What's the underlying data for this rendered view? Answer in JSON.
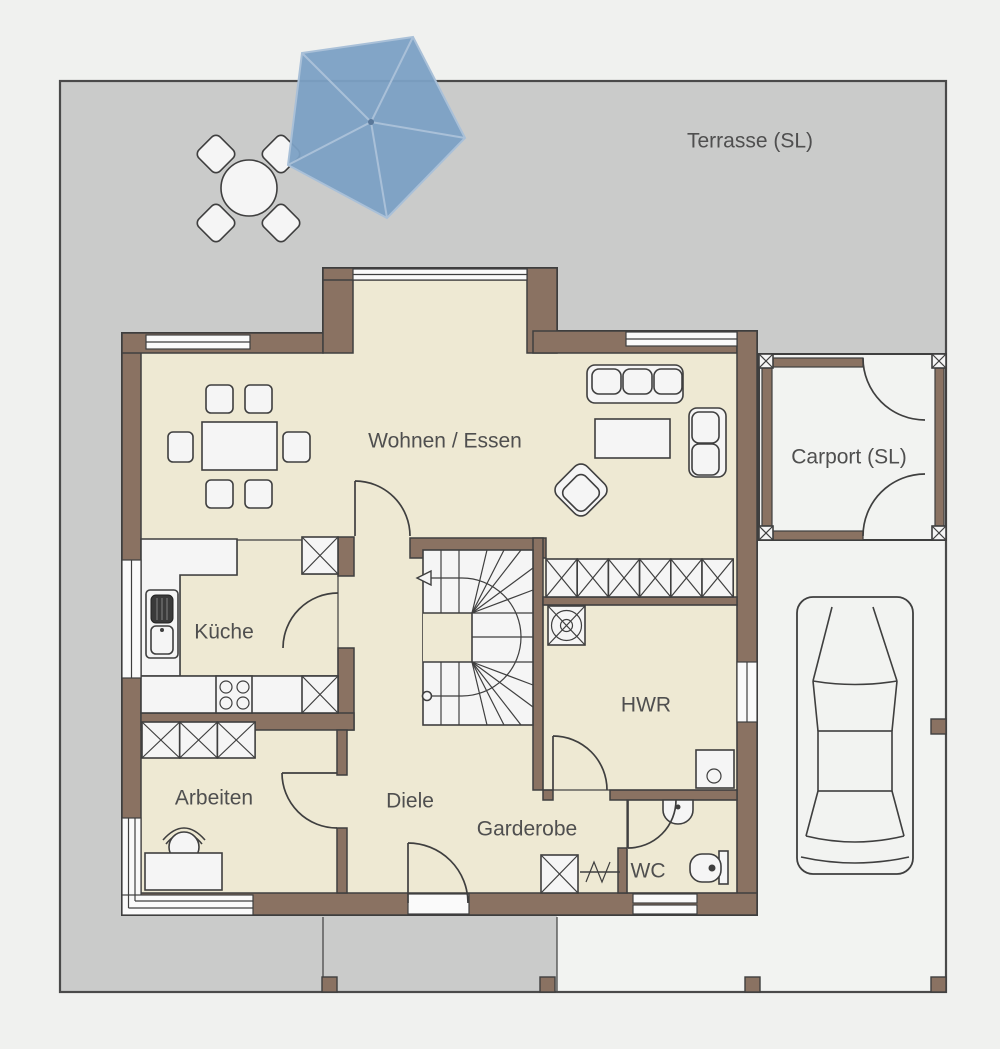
{
  "plan_type": "floor-plan",
  "rooms": [
    {
      "id": "terrasse",
      "label": "Terrasse (SL)",
      "x": 750,
      "y": 141
    },
    {
      "id": "wohnen-essen",
      "label": "Wohnen / Essen",
      "x": 445,
      "y": 441
    },
    {
      "id": "carport",
      "label": "Carport (SL)",
      "x": 849,
      "y": 457
    },
    {
      "id": "kueche",
      "label": "Küche",
      "x": 224,
      "y": 632
    },
    {
      "id": "hwr",
      "label": "HWR",
      "x": 646,
      "y": 705
    },
    {
      "id": "arbeiten",
      "label": "Arbeiten",
      "x": 214,
      "y": 798
    },
    {
      "id": "diele",
      "label": "Diele",
      "x": 410,
      "y": 801
    },
    {
      "id": "garderobe",
      "label": "Garderobe",
      "x": 527,
      "y": 829
    },
    {
      "id": "wc",
      "label": "WC",
      "x": 648,
      "y": 871
    }
  ],
  "colors": {
    "background": "#f0f1ef",
    "terrace": "#cacbca",
    "paving": "#f2f3f1",
    "wall": "#8a7262",
    "floor": "#eee9d3",
    "wet_room": "#c9dcea",
    "furniture": "#f5f5f5",
    "outline": "#3f3f3f",
    "umbrella": "#7ba0c4",
    "umbrella_ribs": "#a9c0d8",
    "label": "#4f4f4f"
  },
  "icons": {
    "parasol-icon": "pentagon parasol top view",
    "patio-table-icon": "round table",
    "patio-chair-icon": "diamond chair",
    "dining-table-icon": "rectangular table with six chairs",
    "sofa-3seat-icon": "three seat sofa",
    "sofa-2seat-icon": "two seat sofa",
    "armchair-icon": "rotated armchair",
    "coffee-table-icon": "rectangle table",
    "sink-unit-icon": "kitchen sink with drainer",
    "stove-icon": "cooktop four burners",
    "wardrobe-cell-icon": "crossed storage cabinet",
    "stairs-icon": "winder staircase with walk line",
    "chimney-icon": "square with cross and circles",
    "washing-machine-icon": "square with circle",
    "washbasin-icon": "half round basin",
    "toilet-icon": "toilet with cistern",
    "coat-rack-icon": "rail with hooks",
    "desk-icon": "desk rectangle",
    "office-chair-icon": "round chair with backrest",
    "car-icon": "car top view",
    "fence-post-icon": "small square post"
  }
}
